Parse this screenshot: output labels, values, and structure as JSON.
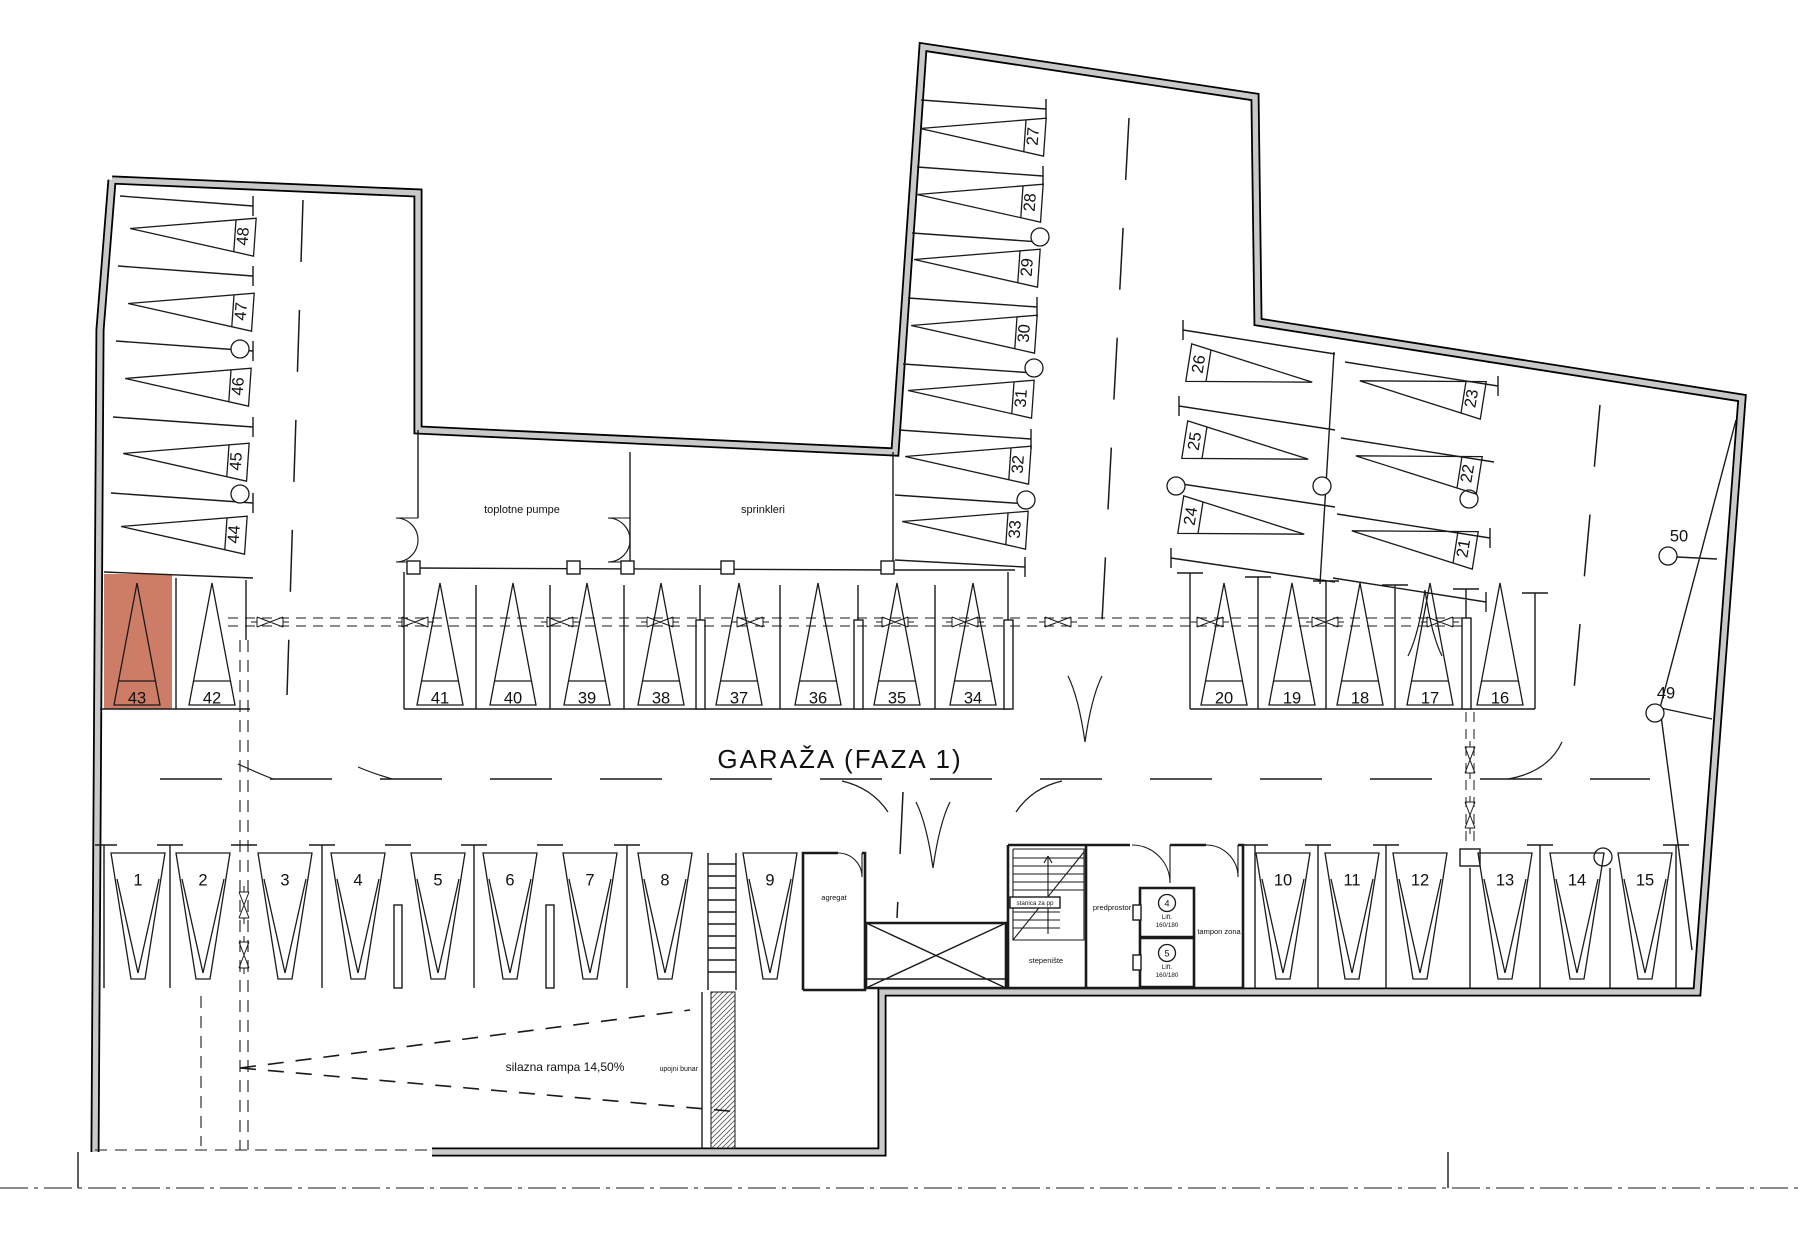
{
  "title": "GARAŽA  (FAZA 1)",
  "labels": {
    "toplotne_pumpe": "toplotne pumpe",
    "sprinkleri": "sprinkleri",
    "agregat": "agregat",
    "stepeniste": "stepenište",
    "predprostor": "predprostor",
    "tampon_zona": "tampon zona",
    "stanica": "stanica za pp",
    "lift4_num": "4",
    "lift5_num": "5",
    "lift_label": "Lift.",
    "lift_size": "160/180",
    "ramp": "silazna rampa 14,50%",
    "well": "upojni bunar"
  },
  "highlight": {
    "space": "43",
    "color": "#cd7c66"
  },
  "spaces": [
    {
      "n": "1",
      "x": 138,
      "y": 917,
      "k": "down"
    },
    {
      "n": "2",
      "x": 203,
      "y": 917,
      "k": "down"
    },
    {
      "n": "3",
      "x": 285,
      "y": 917,
      "k": "down"
    },
    {
      "n": "4",
      "x": 358,
      "y": 917,
      "k": "down"
    },
    {
      "n": "5",
      "x": 438,
      "y": 917,
      "k": "down"
    },
    {
      "n": "6",
      "x": 510,
      "y": 917,
      "k": "down"
    },
    {
      "n": "7",
      "x": 590,
      "y": 917,
      "k": "down"
    },
    {
      "n": "8",
      "x": 665,
      "y": 917,
      "k": "down"
    },
    {
      "n": "9",
      "x": 770,
      "y": 917,
      "k": "down"
    },
    {
      "n": "10",
      "x": 1283,
      "y": 917,
      "k": "down"
    },
    {
      "n": "11",
      "x": 1352,
      "y": 917,
      "k": "down"
    },
    {
      "n": "12",
      "x": 1420,
      "y": 917,
      "k": "down"
    },
    {
      "n": "13",
      "x": 1505,
      "y": 917,
      "k": "down"
    },
    {
      "n": "14",
      "x": 1577,
      "y": 917,
      "k": "down"
    },
    {
      "n": "15",
      "x": 1645,
      "y": 917,
      "k": "down"
    },
    {
      "n": "16",
      "x": 1500,
      "y": 645,
      "k": "up"
    },
    {
      "n": "17",
      "x": 1430,
      "y": 645,
      "k": "up"
    },
    {
      "n": "18",
      "x": 1360,
      "y": 645,
      "k": "up"
    },
    {
      "n": "19",
      "x": 1292,
      "y": 645,
      "k": "up"
    },
    {
      "n": "20",
      "x": 1224,
      "y": 645,
      "k": "up"
    },
    {
      "n": "21",
      "x": 1416,
      "y": 541,
      "k": "left",
      "a": 9
    },
    {
      "n": "22",
      "x": 1420,
      "y": 466,
      "k": "left",
      "a": 9
    },
    {
      "n": "23",
      "x": 1424,
      "y": 391,
      "k": "left",
      "a": 9
    },
    {
      "n": "24",
      "x": 1240,
      "y": 524,
      "k": "right",
      "a": 9
    },
    {
      "n": "25",
      "x": 1244,
      "y": 449,
      "k": "right",
      "a": 9
    },
    {
      "n": "26",
      "x": 1248,
      "y": 372,
      "k": "right",
      "a": 9
    },
    {
      "n": "27",
      "x": 985,
      "y": 133,
      "k": "left",
      "a": 4
    },
    {
      "n": "28",
      "x": 982,
      "y": 199,
      "k": "left",
      "a": 4
    },
    {
      "n": "29",
      "x": 979,
      "y": 264,
      "k": "left",
      "a": 4
    },
    {
      "n": "30",
      "x": 976,
      "y": 330,
      "k": "left",
      "a": 4
    },
    {
      "n": "31",
      "x": 973,
      "y": 395,
      "k": "left",
      "a": 4
    },
    {
      "n": "32",
      "x": 970,
      "y": 461,
      "k": "left",
      "a": 4
    },
    {
      "n": "33",
      "x": 967,
      "y": 526,
      "k": "left",
      "a": 4
    },
    {
      "n": "34",
      "x": 973,
      "y": 645,
      "k": "up"
    },
    {
      "n": "35",
      "x": 897,
      "y": 645,
      "k": "up"
    },
    {
      "n": "36",
      "x": 818,
      "y": 645,
      "k": "up"
    },
    {
      "n": "37",
      "x": 739,
      "y": 645,
      "k": "up"
    },
    {
      "n": "38",
      "x": 661,
      "y": 645,
      "k": "up"
    },
    {
      "n": "39",
      "x": 587,
      "y": 645,
      "k": "up"
    },
    {
      "n": "40",
      "x": 513,
      "y": 645,
      "k": "up"
    },
    {
      "n": "41",
      "x": 440,
      "y": 645,
      "k": "up"
    },
    {
      "n": "42",
      "x": 212,
      "y": 645,
      "k": "up"
    },
    {
      "n": "43",
      "x": 137,
      "y": 645,
      "k": "up",
      "hl": true
    },
    {
      "n": "44",
      "x": 186,
      "y": 531,
      "k": "left",
      "a": 4
    },
    {
      "n": "45",
      "x": 188,
      "y": 458,
      "k": "left",
      "a": 4
    },
    {
      "n": "46",
      "x": 190,
      "y": 383,
      "k": "left",
      "a": 4
    },
    {
      "n": "47",
      "x": 193,
      "y": 308,
      "k": "left",
      "a": 4
    },
    {
      "n": "48",
      "x": 195,
      "y": 233,
      "k": "left",
      "a": 4
    },
    {
      "n": "49",
      "x": 1666,
      "y": 694,
      "k": "mark"
    },
    {
      "n": "50",
      "x": 1679,
      "y": 537,
      "k": "mark"
    }
  ]
}
